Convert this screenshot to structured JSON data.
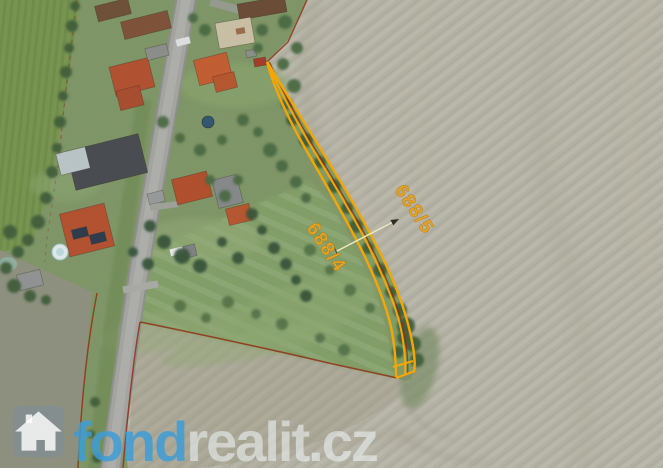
{
  "map": {
    "type": "aerial-cadastral-photo",
    "parcels": [
      {
        "label": "688/5"
      },
      {
        "label": "688/4"
      }
    ],
    "highlight_color": "#F7A600",
    "parcel_label_color": "#E6A11E",
    "cadastral_line_color": "#8E2F10"
  },
  "watermark": {
    "icon": "house-icon",
    "text_bold": "fond",
    "text_light": "realit.cz",
    "bold_color": "#3E9CD6"
  }
}
